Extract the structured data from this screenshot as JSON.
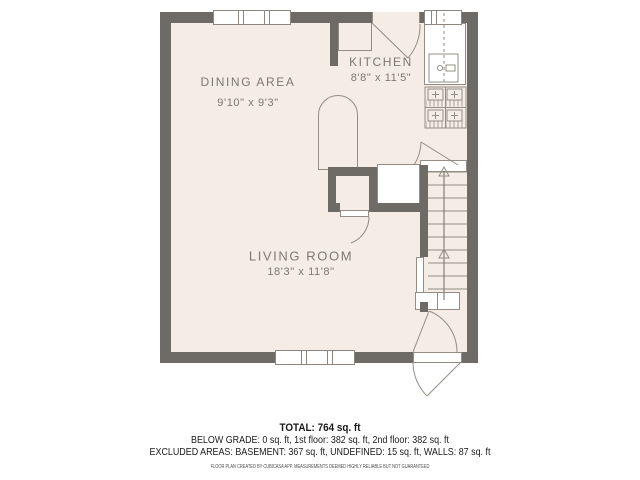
{
  "plan": {
    "rooms": [
      {
        "id": "dining",
        "name": "DINING AREA",
        "dims": "9'10\" x 9'3\""
      },
      {
        "id": "kitchen",
        "name": "KITCHEN",
        "dims": "8'8\" x 11'5\""
      },
      {
        "id": "living",
        "name": "LIVING ROOM",
        "dims": "18'3\" x 11'8\""
      }
    ],
    "features": [
      "window-top-left-3pane",
      "window-top-right-2pane",
      "window-bottom-3pane",
      "kitchen-door",
      "kitchen-counter-left",
      "kitchen-counter-right",
      "sink-icon",
      "stove-icon",
      "arched-opening",
      "closet",
      "closet-door",
      "cabinet",
      "staircase-up",
      "stairs-door",
      "entry-door-double-swing"
    ],
    "stairs_direction": "up"
  },
  "stats": {
    "total": "TOTAL: 764 sq. ft",
    "floors": "BELOW GRADE: 0 sq. ft, 1st floor: 382 sq. ft, 2nd floor: 382 sq. ft",
    "excluded": "EXCLUDED AREAS: BASEMENT: 367 sq. ft, UNDEFINED: 15 sq. ft, WALLS: 87 sq. ft",
    "disclaimer": "FLOOR PLAN CREATED BY CUBICASA APP. MEASUREMENTS DEEMED HIGHLY RELIABLE BUT NOT GUARANTEED"
  },
  "colors": {
    "wall": "#6e6a66",
    "floor": "#f5ede5",
    "thin_line": "#948d85",
    "label_text": "#7d7872",
    "stats_text": "#1a1a1a",
    "background": "#ffffff"
  }
}
